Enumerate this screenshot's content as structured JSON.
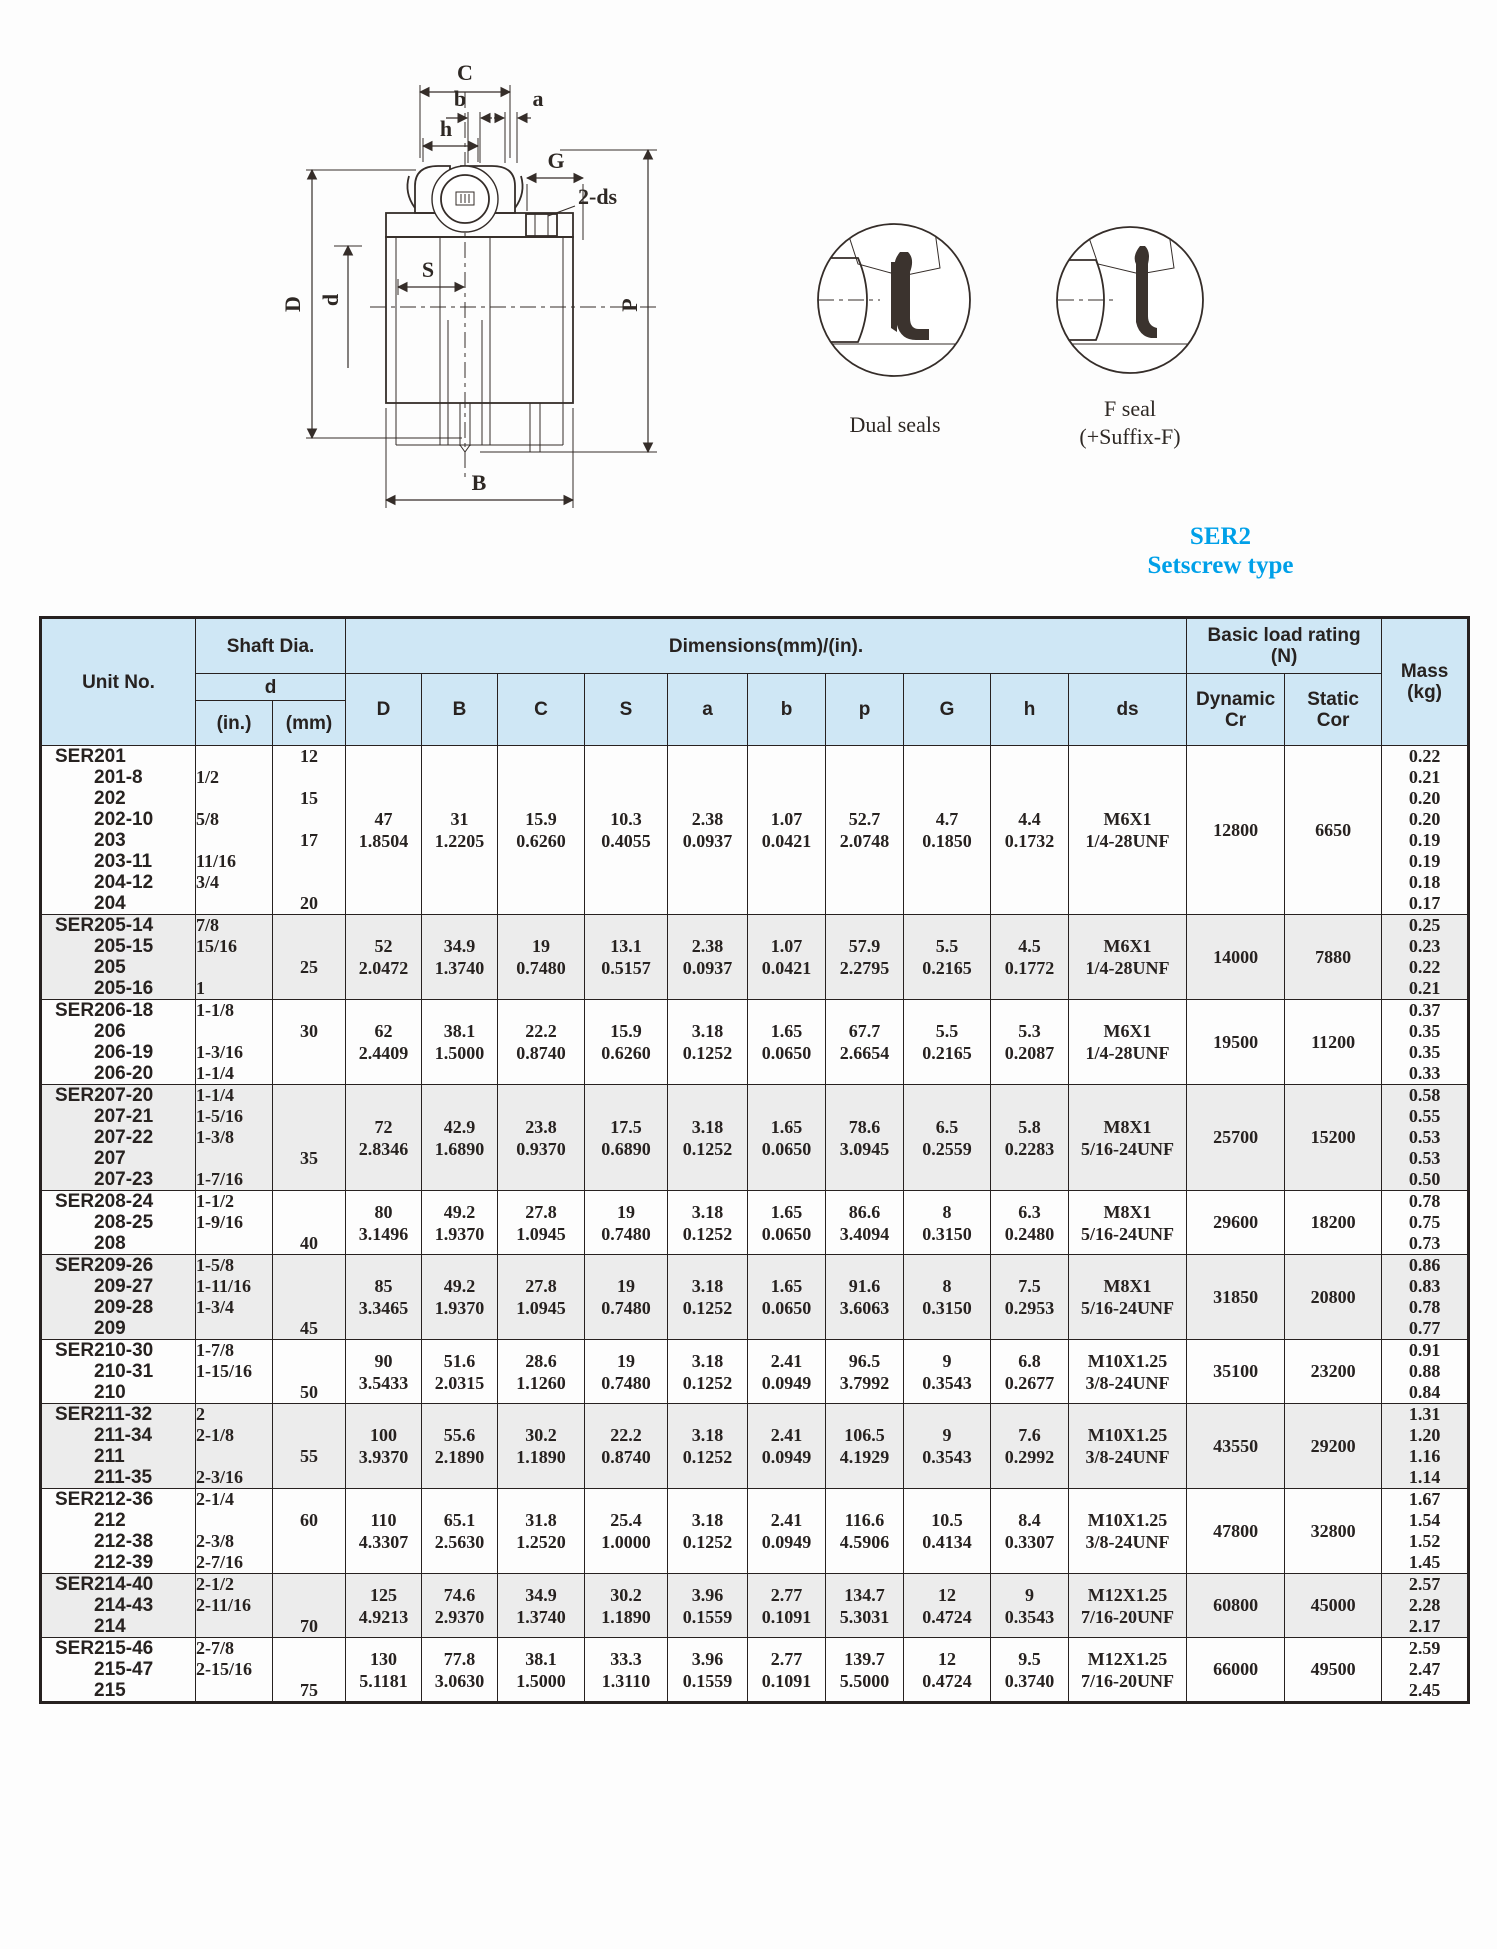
{
  "series": {
    "title": "SER2",
    "subtitle": "Setscrew type",
    "color": "#00a0e8"
  },
  "colors": {
    "header_bg": "#cfe7f5",
    "row_shade": "#ececec",
    "border": "#272120",
    "accent_blue": "#00a0e8"
  },
  "drawing": {
    "labels": {
      "C": "C",
      "b": "b",
      "a": "a",
      "h": "h",
      "G": "G",
      "two_ds": "2-ds",
      "D": "D",
      "d": "d",
      "S": "S",
      "P": "P",
      "B": "B"
    },
    "dual_seal_caption": "Dual seals",
    "f_seal_caption_1": "F seal",
    "f_seal_caption_2": "(+Suffix-F)"
  },
  "table": {
    "header": {
      "unit_no": "Unit No.",
      "shaft_dia": "Shaft Dia.",
      "d": "d",
      "in": "(in.)",
      "mm": "(mm)",
      "dimensions": "Dimensions(mm)/(in).",
      "dim_cols": [
        "D",
        "B",
        "C",
        "S",
        "a",
        "b",
        "p",
        "G",
        "h",
        "ds"
      ],
      "load_rating_1": "Basic load rating",
      "load_rating_2": "(N)",
      "dynamic_1": "Dynamic",
      "dynamic_2": "Cr",
      "static_1": "Static",
      "static_2": "Cor",
      "mass_1": "Mass",
      "mass_2": "(kg)"
    },
    "rows": [
      {
        "shaded": false,
        "unit": [
          "SER201",
          "201-8",
          "202",
          "202-10",
          "203",
          "203-11",
          "204-12",
          "204"
        ],
        "shaft_in": [
          "",
          "1/2",
          "",
          "5/8",
          "",
          "11/16",
          "3/4",
          ""
        ],
        "shaft_mm": [
          "12",
          "",
          "15",
          "",
          "17",
          "",
          "",
          "20"
        ],
        "dims": {
          "D": [
            "47",
            "1.8504"
          ],
          "B": [
            "31",
            "1.2205"
          ],
          "C": [
            "15.9",
            "0.6260"
          ],
          "S": [
            "10.3",
            "0.4055"
          ],
          "a": [
            "2.38",
            "0.0937"
          ],
          "b": [
            "1.07",
            "0.0421"
          ],
          "p": [
            "52.7",
            "2.0748"
          ],
          "G": [
            "4.7",
            "0.1850"
          ],
          "h": [
            "4.4",
            "0.1732"
          ],
          "ds": [
            "M6X1",
            "1/4-28UNF"
          ]
        },
        "cr": "12800",
        "cor": "6650",
        "mass": [
          "0.22",
          "0.21",
          "0.20",
          "0.20",
          "0.19",
          "0.19",
          "0.18",
          "0.17"
        ]
      },
      {
        "shaded": true,
        "unit": [
          "SER205-14",
          "205-15",
          "205",
          "205-16"
        ],
        "shaft_in": [
          "7/8",
          "15/16",
          "",
          "1"
        ],
        "shaft_mm": [
          "",
          "",
          "25",
          ""
        ],
        "dims": {
          "D": [
            "52",
            "2.0472"
          ],
          "B": [
            "34.9",
            "1.3740"
          ],
          "C": [
            "19",
            "0.7480"
          ],
          "S": [
            "13.1",
            "0.5157"
          ],
          "a": [
            "2.38",
            "0.0937"
          ],
          "b": [
            "1.07",
            "0.0421"
          ],
          "p": [
            "57.9",
            "2.2795"
          ],
          "G": [
            "5.5",
            "0.2165"
          ],
          "h": [
            "4.5",
            "0.1772"
          ],
          "ds": [
            "M6X1",
            "1/4-28UNF"
          ]
        },
        "cr": "14000",
        "cor": "7880",
        "mass": [
          "0.25",
          "0.23",
          "0.22",
          "0.21"
        ]
      },
      {
        "shaded": false,
        "unit": [
          "SER206-18",
          "206",
          "206-19",
          "206-20"
        ],
        "shaft_in": [
          "1-1/8",
          "",
          "1-3/16",
          "1-1/4"
        ],
        "shaft_mm": [
          "",
          "30",
          "",
          ""
        ],
        "dims": {
          "D": [
            "62",
            "2.4409"
          ],
          "B": [
            "38.1",
            "1.5000"
          ],
          "C": [
            "22.2",
            "0.8740"
          ],
          "S": [
            "15.9",
            "0.6260"
          ],
          "a": [
            "3.18",
            "0.1252"
          ],
          "b": [
            "1.65",
            "0.0650"
          ],
          "p": [
            "67.7",
            "2.6654"
          ],
          "G": [
            "5.5",
            "0.2165"
          ],
          "h": [
            "5.3",
            "0.2087"
          ],
          "ds": [
            "M6X1",
            "1/4-28UNF"
          ]
        },
        "cr": "19500",
        "cor": "11200",
        "mass": [
          "0.37",
          "0.35",
          "0.35",
          "0.33"
        ]
      },
      {
        "shaded": true,
        "unit": [
          "SER207-20",
          "207-21",
          "207-22",
          "207",
          "207-23"
        ],
        "shaft_in": [
          "1-1/4",
          "1-5/16",
          "1-3/8",
          "",
          "1-7/16"
        ],
        "shaft_mm": [
          "",
          "",
          "",
          "35",
          ""
        ],
        "dims": {
          "D": [
            "72",
            "2.8346"
          ],
          "B": [
            "42.9",
            "1.6890"
          ],
          "C": [
            "23.8",
            "0.9370"
          ],
          "S": [
            "17.5",
            "0.6890"
          ],
          "a": [
            "3.18",
            "0.1252"
          ],
          "b": [
            "1.65",
            "0.0650"
          ],
          "p": [
            "78.6",
            "3.0945"
          ],
          "G": [
            "6.5",
            "0.2559"
          ],
          "h": [
            "5.8",
            "0.2283"
          ],
          "ds": [
            "M8X1",
            "5/16-24UNF"
          ]
        },
        "cr": "25700",
        "cor": "15200",
        "mass": [
          "0.58",
          "0.55",
          "0.53",
          "0.53",
          "0.50"
        ]
      },
      {
        "shaded": false,
        "unit": [
          "SER208-24",
          "208-25",
          "208"
        ],
        "shaft_in": [
          "1-1/2",
          "1-9/16",
          ""
        ],
        "shaft_mm": [
          "",
          "",
          "40"
        ],
        "dims": {
          "D": [
            "80",
            "3.1496"
          ],
          "B": [
            "49.2",
            "1.9370"
          ],
          "C": [
            "27.8",
            "1.0945"
          ],
          "S": [
            "19",
            "0.7480"
          ],
          "a": [
            "3.18",
            "0.1252"
          ],
          "b": [
            "1.65",
            "0.0650"
          ],
          "p": [
            "86.6",
            "3.4094"
          ],
          "G": [
            "8",
            "0.3150"
          ],
          "h": [
            "6.3",
            "0.2480"
          ],
          "ds": [
            "M8X1",
            "5/16-24UNF"
          ]
        },
        "cr": "29600",
        "cor": "18200",
        "mass": [
          "0.78",
          "0.75",
          "0.73"
        ]
      },
      {
        "shaded": true,
        "unit": [
          "SER209-26",
          "209-27",
          "209-28",
          "209"
        ],
        "shaft_in": [
          "1-5/8",
          "1-11/16",
          "1-3/4",
          ""
        ],
        "shaft_mm": [
          "",
          "",
          "",
          "45"
        ],
        "dims": {
          "D": [
            "85",
            "3.3465"
          ],
          "B": [
            "49.2",
            "1.9370"
          ],
          "C": [
            "27.8",
            "1.0945"
          ],
          "S": [
            "19",
            "0.7480"
          ],
          "a": [
            "3.18",
            "0.1252"
          ],
          "b": [
            "1.65",
            "0.0650"
          ],
          "p": [
            "91.6",
            "3.6063"
          ],
          "G": [
            "8",
            "0.3150"
          ],
          "h": [
            "7.5",
            "0.2953"
          ],
          "ds": [
            "M8X1",
            "5/16-24UNF"
          ]
        },
        "cr": "31850",
        "cor": "20800",
        "mass": [
          "0.86",
          "0.83",
          "0.78",
          "0.77"
        ]
      },
      {
        "shaded": false,
        "unit": [
          "SER210-30",
          "210-31",
          "210"
        ],
        "shaft_in": [
          "1-7/8",
          "1-15/16",
          ""
        ],
        "shaft_mm": [
          "",
          "",
          "50"
        ],
        "dims": {
          "D": [
            "90",
            "3.5433"
          ],
          "B": [
            "51.6",
            "2.0315"
          ],
          "C": [
            "28.6",
            "1.1260"
          ],
          "S": [
            "19",
            "0.7480"
          ],
          "a": [
            "3.18",
            "0.1252"
          ],
          "b": [
            "2.41",
            "0.0949"
          ],
          "p": [
            "96.5",
            "3.7992"
          ],
          "G": [
            "9",
            "0.3543"
          ],
          "h": [
            "6.8",
            "0.2677"
          ],
          "ds": [
            "M10X1.25",
            "3/8-24UNF"
          ]
        },
        "cr": "35100",
        "cor": "23200",
        "mass": [
          "0.91",
          "0.88",
          "0.84"
        ]
      },
      {
        "shaded": true,
        "unit": [
          "SER211-32",
          "211-34",
          "211",
          "211-35"
        ],
        "shaft_in": [
          "2",
          "2-1/8",
          "",
          "2-3/16"
        ],
        "shaft_mm": [
          "",
          "",
          "55",
          ""
        ],
        "dims": {
          "D": [
            "100",
            "3.9370"
          ],
          "B": [
            "55.6",
            "2.1890"
          ],
          "C": [
            "30.2",
            "1.1890"
          ],
          "S": [
            "22.2",
            "0.8740"
          ],
          "a": [
            "3.18",
            "0.1252"
          ],
          "b": [
            "2.41",
            "0.0949"
          ],
          "p": [
            "106.5",
            "4.1929"
          ],
          "G": [
            "9",
            "0.3543"
          ],
          "h": [
            "7.6",
            "0.2992"
          ],
          "ds": [
            "M10X1.25",
            "3/8-24UNF"
          ]
        },
        "cr": "43550",
        "cor": "29200",
        "mass": [
          "1.31",
          "1.20",
          "1.16",
          "1.14"
        ]
      },
      {
        "shaded": false,
        "unit": [
          "SER212-36",
          "212",
          "212-38",
          "212-39"
        ],
        "shaft_in": [
          "2-1/4",
          "",
          "2-3/8",
          "2-7/16"
        ],
        "shaft_mm": [
          "",
          "60",
          "",
          ""
        ],
        "dims": {
          "D": [
            "110",
            "4.3307"
          ],
          "B": [
            "65.1",
            "2.5630"
          ],
          "C": [
            "31.8",
            "1.2520"
          ],
          "S": [
            "25.4",
            "1.0000"
          ],
          "a": [
            "3.18",
            "0.1252"
          ],
          "b": [
            "2.41",
            "0.0949"
          ],
          "p": [
            "116.6",
            "4.5906"
          ],
          "G": [
            "10.5",
            "0.4134"
          ],
          "h": [
            "8.4",
            "0.3307"
          ],
          "ds": [
            "M10X1.25",
            "3/8-24UNF"
          ]
        },
        "cr": "47800",
        "cor": "32800",
        "mass": [
          "1.67",
          "1.54",
          "1.52",
          "1.45"
        ]
      },
      {
        "shaded": true,
        "unit": [
          "SER214-40",
          "214-43",
          "214"
        ],
        "shaft_in": [
          "2-1/2",
          "2-11/16",
          ""
        ],
        "shaft_mm": [
          "",
          "",
          "70"
        ],
        "dims": {
          "D": [
            "125",
            "4.9213"
          ],
          "B": [
            "74.6",
            "2.9370"
          ],
          "C": [
            "34.9",
            "1.3740"
          ],
          "S": [
            "30.2",
            "1.1890"
          ],
          "a": [
            "3.96",
            "0.1559"
          ],
          "b": [
            "2.77",
            "0.1091"
          ],
          "p": [
            "134.7",
            "5.3031"
          ],
          "G": [
            "12",
            "0.4724"
          ],
          "h": [
            "9",
            "0.3543"
          ],
          "ds": [
            "M12X1.25",
            "7/16-20UNF"
          ]
        },
        "cr": "60800",
        "cor": "45000",
        "mass": [
          "2.57",
          "2.28",
          "2.17"
        ]
      },
      {
        "shaded": false,
        "unit": [
          "SER215-46",
          "215-47",
          "215"
        ],
        "shaft_in": [
          "2-7/8",
          "2-15/16",
          ""
        ],
        "shaft_mm": [
          "",
          "",
          "75"
        ],
        "dims": {
          "D": [
            "130",
            "5.1181"
          ],
          "B": [
            "77.8",
            "3.0630"
          ],
          "C": [
            "38.1",
            "1.5000"
          ],
          "S": [
            "33.3",
            "1.3110"
          ],
          "a": [
            "3.96",
            "0.1559"
          ],
          "b": [
            "2.77",
            "0.1091"
          ],
          "p": [
            "139.7",
            "5.5000"
          ],
          "G": [
            "12",
            "0.4724"
          ],
          "h": [
            "9.5",
            "0.3740"
          ],
          "ds": [
            "M12X1.25",
            "7/16-20UNF"
          ]
        },
        "cr": "66000",
        "cor": "49500",
        "mass": [
          "2.59",
          "2.47",
          "2.45"
        ]
      }
    ]
  }
}
